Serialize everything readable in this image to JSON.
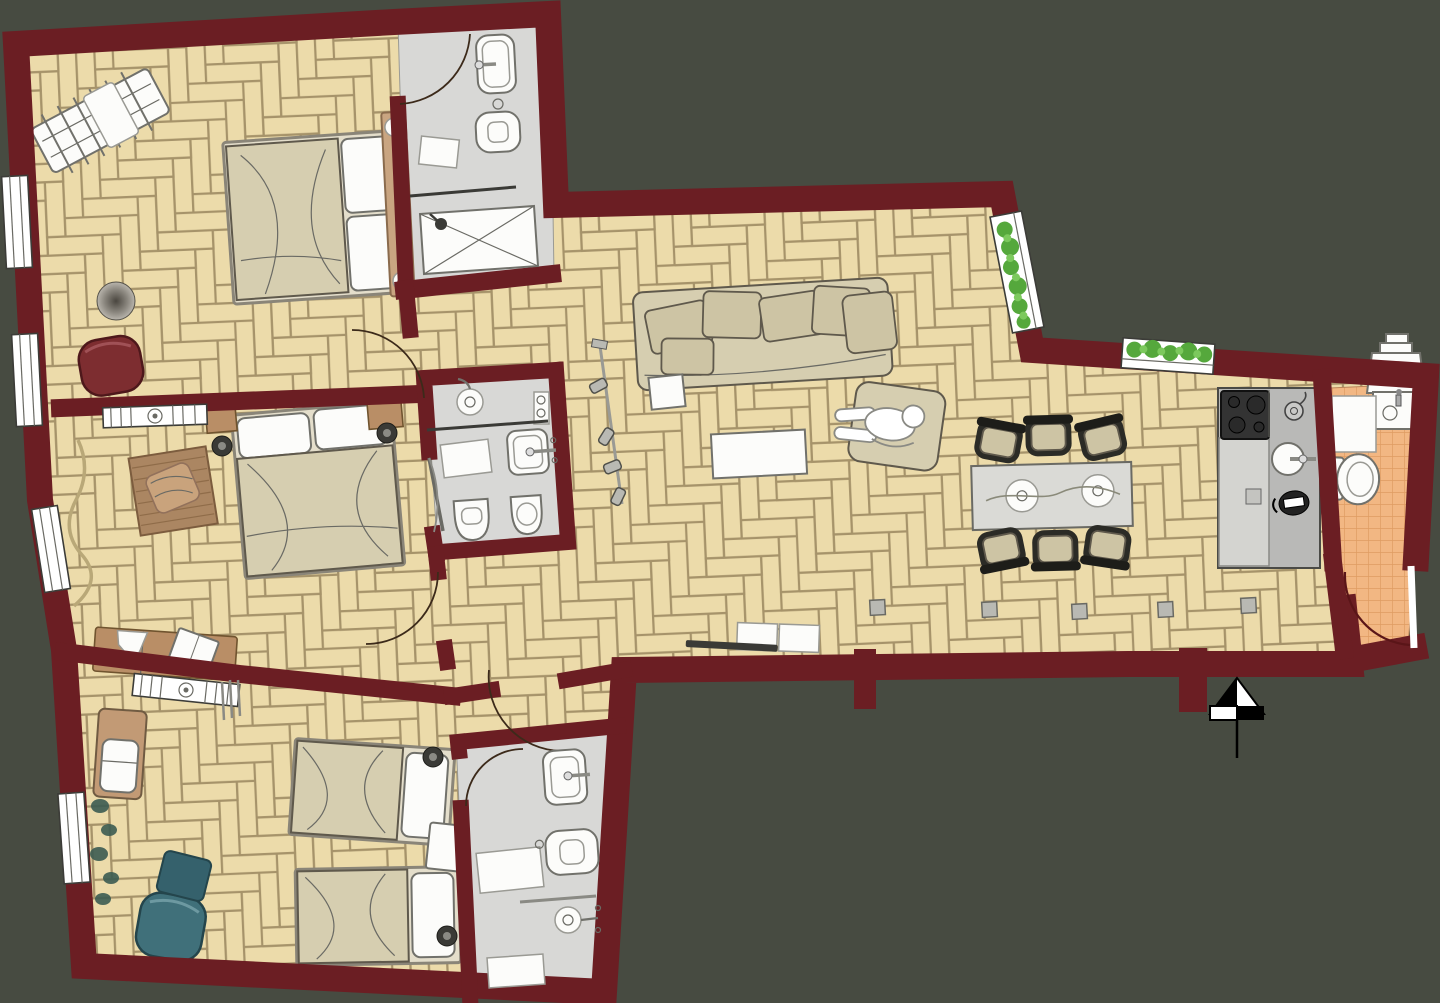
{
  "title": "Apartment floor plan — top view with furniture",
  "colors": {
    "bg": "#474b41",
    "wall": "#6b1e23",
    "parquet": "#ecdbaa",
    "parquet_line": "#a6936a",
    "bath_floor": "#d8d8d6",
    "wc_tile": "#f2b783",
    "wc_tile_line": "#de9c62",
    "fixture_white": "#fcfcfa",
    "fixture_stroke": "#71716b",
    "furn_beige": "#d6ceb0",
    "cushion": "#cdc4a4",
    "furn_outline": "#5f594c",
    "headboard_tan": "#c9a581",
    "wood_brown": "#b98e66",
    "rug_brown": "#ab8662",
    "red_chair": "#7d2d30",
    "teal_chair": "#40707a",
    "plant_green": "#55a83c",
    "counter_gray": "#b9b9b7",
    "counter_light": "#d4d4d0",
    "cooktop_black": "#333333",
    "chair_frame": "#2b2b26",
    "lamp_dark": "#3a3a36",
    "north_black": "#000000"
  },
  "compass": {
    "symbol": "north-arrow"
  },
  "rooms": [
    {
      "id": "bedroom-master",
      "floor": "parquet",
      "furniture": [
        "double-bed",
        "headboard",
        "clothes-drying-rack",
        "floor-cushion",
        "armchair-red",
        "radiator",
        "curtain",
        "window",
        "window"
      ]
    },
    {
      "id": "bathroom-top",
      "floor": "stone",
      "furniture": [
        "washbasin",
        "toilet",
        "shower-tray",
        "glass-partition",
        "bath-mat",
        "door"
      ]
    },
    {
      "id": "bedroom-middle",
      "floor": "parquet",
      "furniture": [
        "double-bed",
        "nightstand",
        "nightstand",
        "reading-lamp",
        "reading-lamp",
        "rug-with-blanket",
        "bench-with-book",
        "radiator",
        "window",
        "door"
      ]
    },
    {
      "id": "bathroom-middle",
      "floor": "stone",
      "furniture": [
        "shower-head",
        "glass-partition",
        "shelf",
        "bath-mat",
        "washbasin",
        "toilet",
        "bidet",
        "door"
      ]
    },
    {
      "id": "living-dining",
      "floor": "parquet",
      "furniture": [
        "sofa",
        "sofa-cushions",
        "side-table",
        "coffee-table",
        "armchair-with-person",
        "track-light",
        "media-bench",
        "tv",
        "dining-table",
        "plates",
        "dining-chair",
        "dining-chair",
        "dining-chair",
        "dining-chair",
        "dining-chair",
        "dining-chair",
        "floor-socket",
        "floor-socket",
        "floor-socket",
        "floor-socket",
        "floor-socket",
        "window-plant-box"
      ]
    },
    {
      "id": "kitchen",
      "floor": "parquet",
      "furniture": [
        "counter",
        "cooktop-4-burners",
        "round-sink",
        "kettle",
        "espresso-pot",
        "cutting-board",
        "window-plant-box"
      ]
    },
    {
      "id": "wc-entry",
      "floor": "orange-tile",
      "furniture": [
        "water-heater",
        "corner-washbasin",
        "cabinet",
        "toilet",
        "entry-door"
      ]
    },
    {
      "id": "bedroom-children",
      "floor": "parquet",
      "furniture": [
        "single-bed",
        "single-bed",
        "nightstand",
        "wall-lamp",
        "wall-lamp",
        "armchair-teal",
        "ottoman-teal",
        "changing-table",
        "plant-vine",
        "radiator",
        "window",
        "door"
      ]
    },
    {
      "id": "bathroom-children",
      "floor": "stone",
      "furniture": [
        "washbasin",
        "toilet",
        "shower-head",
        "glass-partition",
        "bath-mat",
        "bath-mat",
        "door"
      ]
    },
    {
      "id": "hallway",
      "floor": "parquet",
      "furniture": [
        "door-arcs"
      ]
    }
  ]
}
